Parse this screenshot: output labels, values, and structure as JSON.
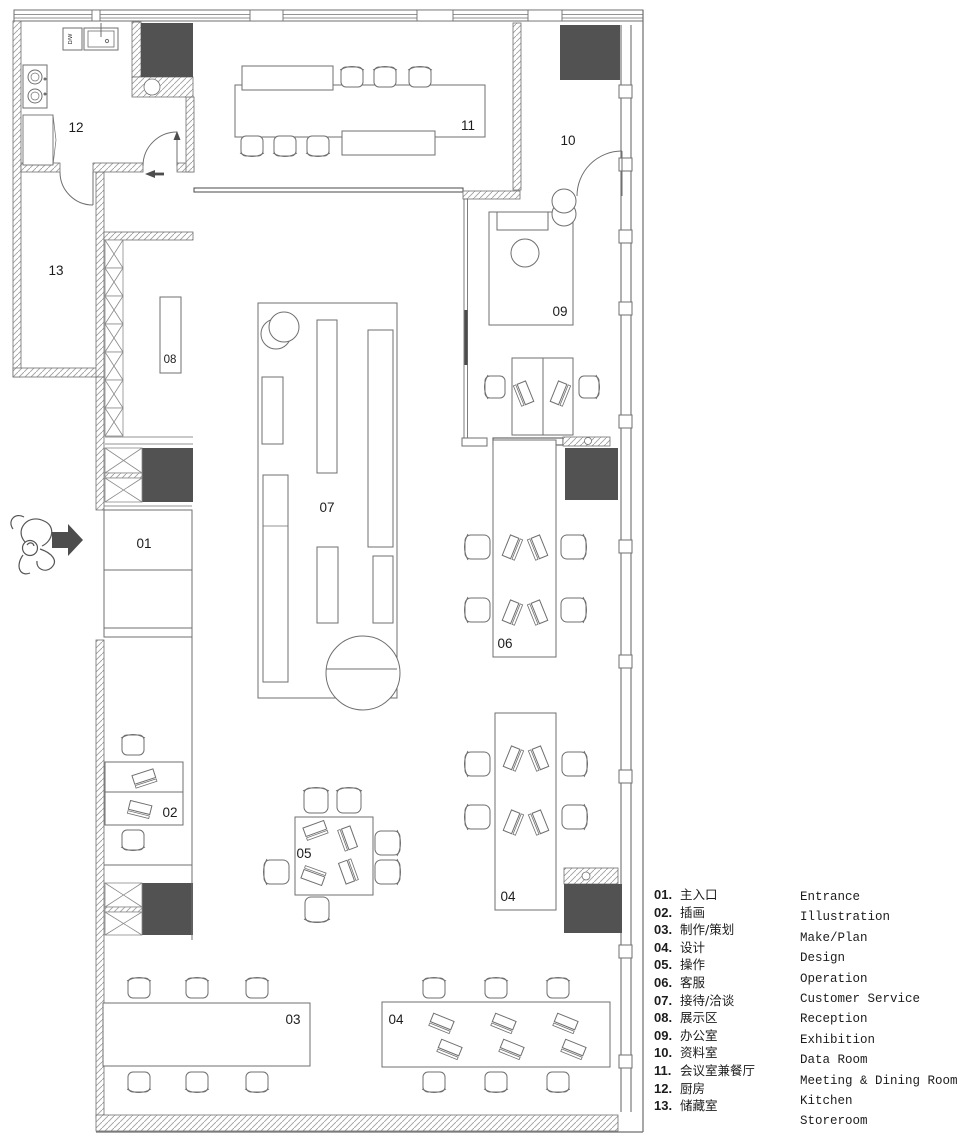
{
  "plan": {
    "labels": {
      "r01": "01",
      "r02": "02",
      "r03": "03",
      "r04_upper": "04",
      "r04_lower": "04",
      "r05": "05",
      "r06": "06",
      "r07": "07",
      "r08": "08",
      "r09": "09",
      "r10": "10",
      "r11": "11",
      "r12": "12",
      "r13": "13",
      "dw": "D/W"
    },
    "colors": {
      "dark_block": "#525252",
      "wall_line": "#6f6f6f",
      "hatch_line": "#a0a0a0",
      "label_text": "#1c1c1c",
      "arrow_fill": "#4d4d4d"
    }
  },
  "legend": {
    "rows_zh": [
      {
        "num": "01.",
        "label": "主入口"
      },
      {
        "num": "02.",
        "label": "插画"
      },
      {
        "num": "03.",
        "label": "制作/策划"
      },
      {
        "num": "04.",
        "label": "设计"
      },
      {
        "num": "05.",
        "label": "操作"
      },
      {
        "num": "06.",
        "label": "客服"
      },
      {
        "num": "07.",
        "label": "接待/洽谈"
      },
      {
        "num": "08.",
        "label": "展示区"
      },
      {
        "num": "09.",
        "label": "办公室"
      },
      {
        "num": "10.",
        "label": "资料室"
      },
      {
        "num": "11.",
        "label": "会议室兼餐厅"
      },
      {
        "num": "12.",
        "label": "厨房"
      },
      {
        "num": "13.",
        "label": "储藏室"
      }
    ],
    "rows_en": [
      "Entrance",
      "Illustration",
      "Make/Plan",
      "Design",
      "Operation",
      "Customer Service",
      "Reception",
      "Exhibition",
      "Data Room",
      "Meeting & Dining Room",
      "Kitchen",
      "Storeroom"
    ]
  }
}
